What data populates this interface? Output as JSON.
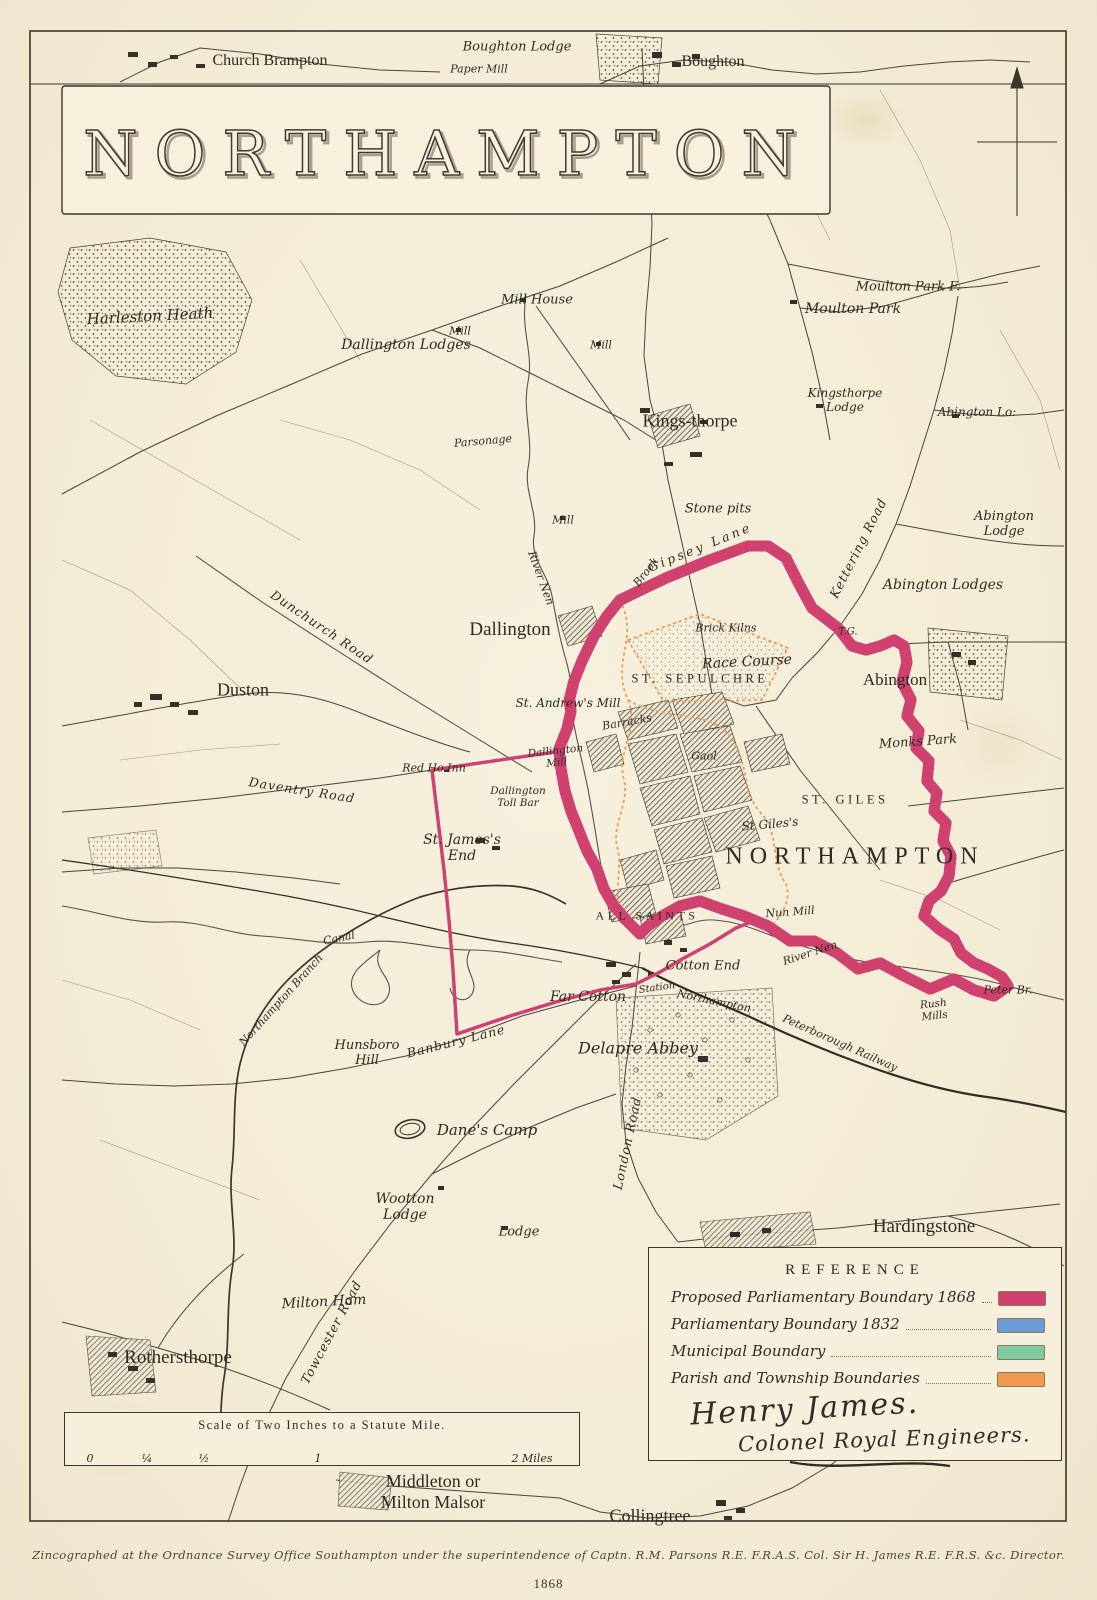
{
  "title": "NORTHAMPTON",
  "colors": {
    "proposed_1868": "#cf4170",
    "parliamentary_1832": "#6d9bd8",
    "municipal": "#7ec9a2",
    "parish_township": "#f09a50",
    "ink": "#3a352e",
    "paper": "#f4eeda"
  },
  "legend": {
    "header": "REFERENCE",
    "items": [
      {
        "label": "Proposed Parliamentary Boundary 1868",
        "color": "#cf4170"
      },
      {
        "label": "Parliamentary Boundary 1832",
        "color": "#6d9bd8"
      },
      {
        "label": "Municipal Boundary",
        "color": "#7ec9a2"
      },
      {
        "label": "Parish and Township Boundaries",
        "color": "#f09a50"
      }
    ]
  },
  "signature": {
    "line1": "Henry James.",
    "line2": "Colonel Royal Engineers."
  },
  "scale_bar": {
    "title": "Scale of Two Inches to a Statute Mile.",
    "tick_labels": [
      "0",
      "¼",
      "½",
      "1",
      "2 Miles"
    ]
  },
  "imprint": "Zincographed at the Ordnance Survey Office Southampton under the superintendence of Captn. R.M. Parsons R.E. F.R.A.S. Col. Sir H. James R.E. F.R.S. &c. Director.",
  "year": "1868",
  "map": {
    "labels": [
      {
        "t": "Church Brampton",
        "x": 270,
        "y": 61,
        "c": "v2"
      },
      {
        "t": "Boughton Lodge",
        "x": 517,
        "y": 47,
        "c": "f"
      },
      {
        "t": "Paper Mill",
        "x": 479,
        "y": 69,
        "c": "fs"
      },
      {
        "t": "Boughton",
        "x": 713,
        "y": 62,
        "c": "v2"
      },
      {
        "t": "Harleston Heath",
        "x": 150,
        "y": 316,
        "c": "f",
        "s": 15,
        "r": -3
      },
      {
        "t": "Mill House",
        "x": 537,
        "y": 300,
        "c": "f"
      },
      {
        "t": "Mill",
        "x": 460,
        "y": 331,
        "c": "fs"
      },
      {
        "t": "Dallington Lodges",
        "x": 406,
        "y": 345,
        "c": "f",
        "s": 14
      },
      {
        "t": "Mill",
        "x": 601,
        "y": 345,
        "c": "fs"
      },
      {
        "t": "Moulton Park F.",
        "x": 908,
        "y": 287,
        "c": "f"
      },
      {
        "t": "Moulton Park",
        "x": 853,
        "y": 309,
        "c": "f",
        "s": 14
      },
      {
        "t": "Kings-thorpe",
        "x": 690,
        "y": 421,
        "c": "v1",
        "s": 18
      },
      {
        "t": "Parsonage",
        "x": 483,
        "y": 441,
        "c": "fs",
        "r": -5
      },
      {
        "t": "Kingsthorpe\nLodge",
        "x": 845,
        "y": 400,
        "c": "fs",
        "s": 12
      },
      {
        "t": "Abington Lo:",
        "x": 977,
        "y": 412,
        "c": "fs",
        "s": 12
      },
      {
        "t": "Mill",
        "x": 563,
        "y": 520,
        "c": "fs"
      },
      {
        "t": "Stone pits",
        "x": 718,
        "y": 509,
        "c": "f"
      },
      {
        "t": "Gipsey Lane",
        "x": 700,
        "y": 547,
        "c": "rd",
        "r": -22,
        "sp": 3
      },
      {
        "t": "Brook",
        "x": 646,
        "y": 572,
        "c": "fs",
        "r": -52
      },
      {
        "t": "Kettering Road",
        "x": 858,
        "y": 548,
        "c": "rd",
        "r": -63
      },
      {
        "t": "Abington\nLodge",
        "x": 1004,
        "y": 524,
        "c": "f"
      },
      {
        "t": "Abington Lodges",
        "x": 943,
        "y": 585,
        "c": "f",
        "s": 14
      },
      {
        "t": "River Nen",
        "x": 541,
        "y": 578,
        "c": "fs",
        "r": 70
      },
      {
        "t": "T.G.",
        "x": 848,
        "y": 632,
        "c": "fs",
        "s": 10
      },
      {
        "t": "Brick Kilns",
        "x": 726,
        "y": 628,
        "c": "fs"
      },
      {
        "t": "Race Course",
        "x": 747,
        "y": 662,
        "c": "f",
        "s": 14,
        "r": -3
      },
      {
        "t": "ST. SEPULCHRE",
        "x": 700,
        "y": 679,
        "c": "dist"
      },
      {
        "t": "Dallington",
        "x": 510,
        "y": 630,
        "c": "v1"
      },
      {
        "t": "Dunchurch Road",
        "x": 322,
        "y": 627,
        "c": "rd",
        "r": 34
      },
      {
        "t": "Duston",
        "x": 243,
        "y": 690,
        "c": "v1",
        "s": 18
      },
      {
        "t": "St. Andrew's Mill",
        "x": 568,
        "y": 703,
        "c": "fs",
        "s": 12
      },
      {
        "t": "Abington",
        "x": 895,
        "y": 680,
        "c": "v2",
        "s": 17
      },
      {
        "t": "Monks Park",
        "x": 918,
        "y": 742,
        "c": "f",
        "r": -4
      },
      {
        "t": "Red Ho Inn",
        "x": 434,
        "y": 768,
        "c": "fs"
      },
      {
        "t": "Daventry Road",
        "x": 302,
        "y": 790,
        "c": "rd",
        "r": 9
      },
      {
        "t": "Dallington\nMill",
        "x": 556,
        "y": 757,
        "c": "fs",
        "s": 10.5,
        "r": -6
      },
      {
        "t": "Dallington\nToll Bar",
        "x": 518,
        "y": 797,
        "c": "fs",
        "s": 10.5
      },
      {
        "t": "Barracks",
        "x": 627,
        "y": 722,
        "c": "fs",
        "r": -10
      },
      {
        "t": "Gaol",
        "x": 704,
        "y": 756,
        "c": "fs"
      },
      {
        "t": "St Giles's",
        "x": 770,
        "y": 824,
        "c": "fs",
        "s": 12,
        "r": -5
      },
      {
        "t": "ST. GILES",
        "x": 845,
        "y": 800,
        "c": "dist"
      },
      {
        "t": "NORTHAMPTON",
        "x": 855,
        "y": 857,
        "c": "town"
      },
      {
        "t": "St. James's\nEnd",
        "x": 462,
        "y": 848,
        "c": "f",
        "s": 14
      },
      {
        "t": "ALL SAINTS",
        "x": 647,
        "y": 916,
        "c": "dist",
        "s": 12
      },
      {
        "t": "Nun Mill",
        "x": 790,
        "y": 912,
        "c": "fs",
        "r": -4
      },
      {
        "t": "River Nen",
        "x": 810,
        "y": 953,
        "c": "fs",
        "r": -18
      },
      {
        "t": "Cotton End",
        "x": 703,
        "y": 966,
        "c": "f"
      },
      {
        "t": "Far Cotton",
        "x": 588,
        "y": 997,
        "c": "f",
        "s": 14
      },
      {
        "t": "Station",
        "x": 657,
        "y": 988,
        "c": "fs",
        "s": 10,
        "r": -8
      },
      {
        "t": "Northampton",
        "x": 714,
        "y": 1001,
        "c": "fs",
        "r": 12
      },
      {
        "t": "Peterborough Railway",
        "x": 840,
        "y": 1043,
        "c": "fs",
        "r": 24
      },
      {
        "t": "Rush\nMills",
        "x": 934,
        "y": 1010,
        "c": "fs",
        "s": 10.5,
        "r": -6
      },
      {
        "t": "Peter Br.",
        "x": 1008,
        "y": 990,
        "c": "fs"
      },
      {
        "t": "Delapre Abbey",
        "x": 638,
        "y": 1048,
        "c": "f",
        "s": 16
      },
      {
        "t": "Canal",
        "x": 339,
        "y": 938,
        "c": "fs",
        "r": -12
      },
      {
        "t": "Northampton Branch",
        "x": 281,
        "y": 1000,
        "c": "fs",
        "r": -48
      },
      {
        "t": "Hunsboro\nHill",
        "x": 367,
        "y": 1053,
        "c": "f"
      },
      {
        "t": "Banbury Lane",
        "x": 456,
        "y": 1041,
        "c": "rd",
        "r": -14
      },
      {
        "t": "Dane's Camp",
        "x": 487,
        "y": 1130,
        "c": "f",
        "s": 15
      },
      {
        "t": "Wootton\nLodge",
        "x": 405,
        "y": 1207,
        "c": "f",
        "s": 14
      },
      {
        "t": "Lodge",
        "x": 519,
        "y": 1232,
        "c": "f"
      },
      {
        "t": "London Road",
        "x": 627,
        "y": 1143,
        "c": "rd",
        "r": -78
      },
      {
        "t": "Hardingstone",
        "x": 924,
        "y": 1227,
        "c": "v1"
      },
      {
        "t": "Milton Ham",
        "x": 324,
        "y": 1302,
        "c": "f",
        "s": 14,
        "r": -3
      },
      {
        "t": "Towcester Road",
        "x": 331,
        "y": 1332,
        "c": "rd",
        "r": -62
      },
      {
        "t": "Rothersthorpe",
        "x": 178,
        "y": 1358,
        "c": "v1"
      },
      {
        "t": "Middleton or\nMilton Malsor",
        "x": 433,
        "y": 1492,
        "c": "v1",
        "s": 18
      },
      {
        "t": "Collingtree",
        "x": 650,
        "y": 1516,
        "c": "v1",
        "s": 18
      }
    ]
  }
}
